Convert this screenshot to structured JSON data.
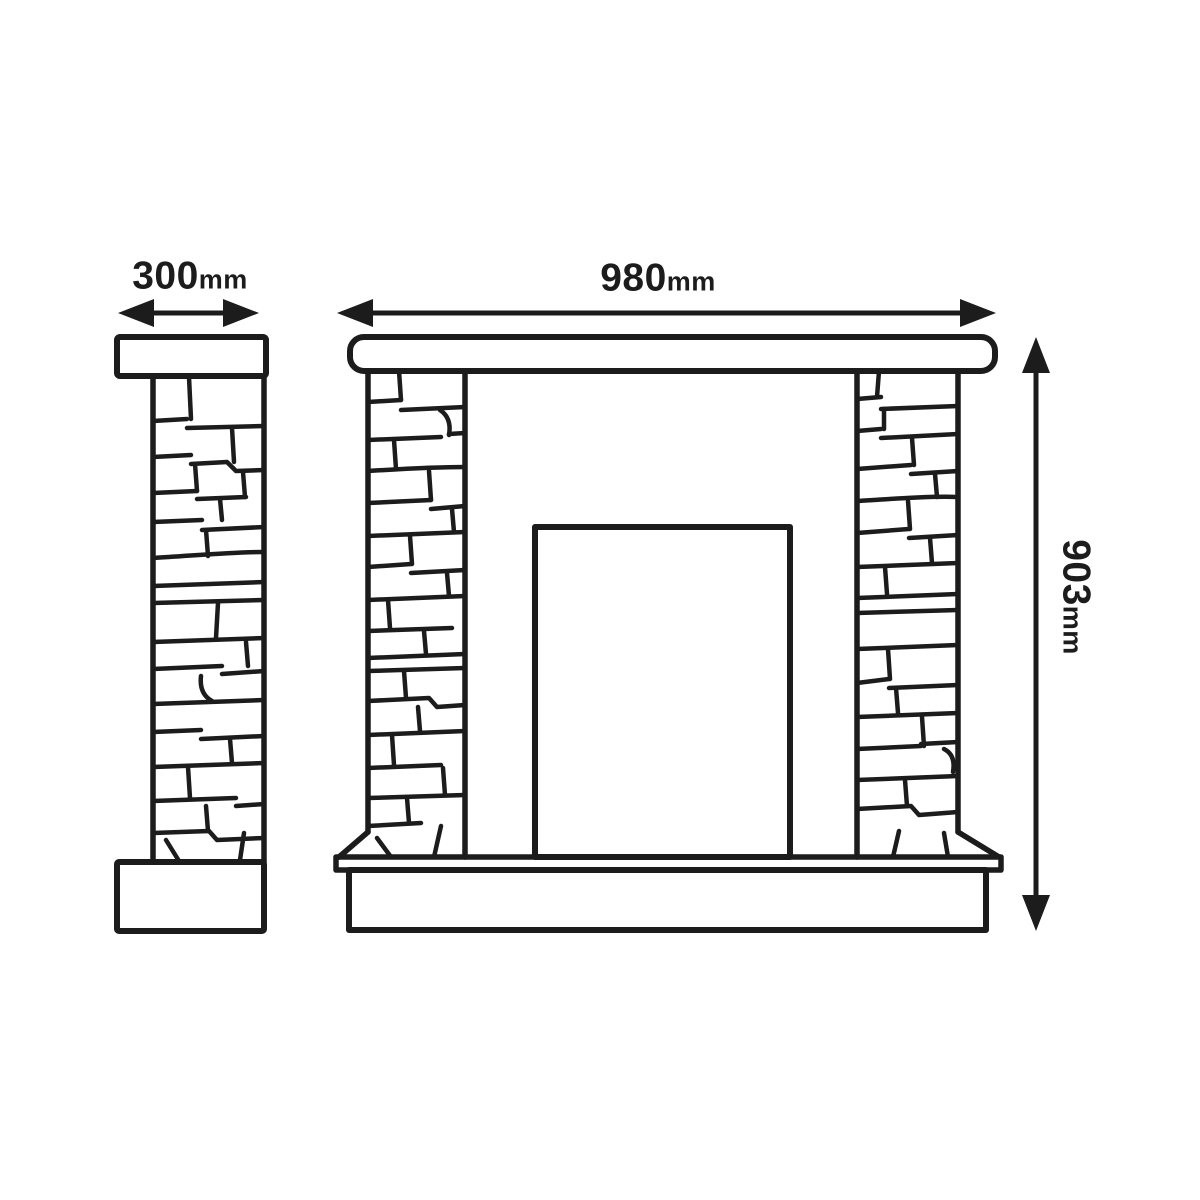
{
  "diagram": {
    "dimensions": {
      "side_depth": {
        "value": "300",
        "unit": "mm"
      },
      "front_width": {
        "value": "980",
        "unit": "mm"
      },
      "height": {
        "value": "903",
        "unit": "mm"
      }
    },
    "colors": {
      "line": "#1c1c1c",
      "background": "#ffffff"
    }
  }
}
